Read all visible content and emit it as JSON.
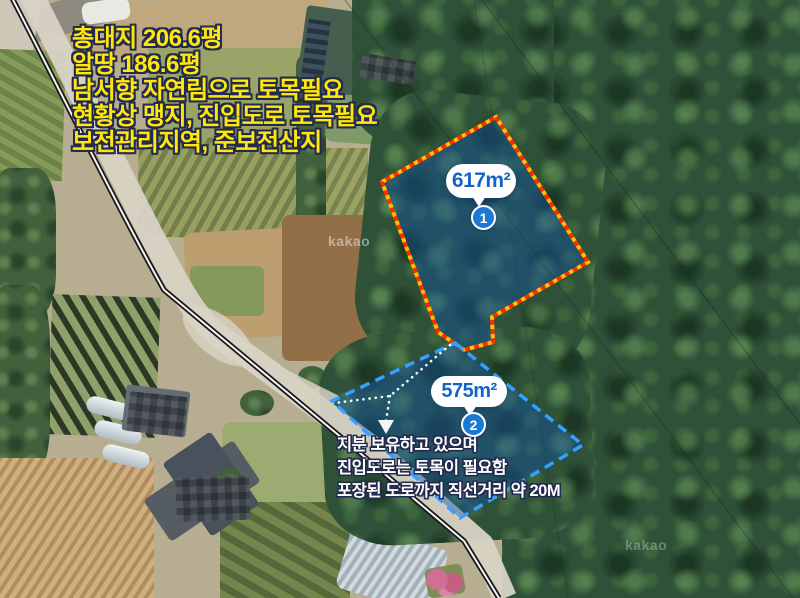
{
  "map": {
    "watermarks": [
      "kakao",
      "kakao"
    ]
  },
  "notes": {
    "top": {
      "color": "#ffe70a",
      "outline_color": "#222a4e",
      "lines": [
        "총대지 206.6평",
        "알땅 186.6평",
        "남서향 자연림으로 토목필요",
        "현황상 맹지, 진입도로 토목필요",
        "보전관리지역, 준보전산지"
      ]
    },
    "bottom": {
      "color": "#ffffff",
      "outline_color": "#222a4e",
      "lines": [
        "지분 보유하고 있으며",
        "진입도로는 토목이 필요함",
        "포장된 도로까지 직선거리 약 20M"
      ]
    }
  },
  "parcels": [
    {
      "badge": "1",
      "area": "617m²",
      "outline": "#ff2b00",
      "outline_accent": "#ffc400",
      "fill": "rgba(17,82,168,0.42)",
      "label_color": "#1464c8"
    },
    {
      "badge": "2",
      "area": "575m²",
      "outline": "#34a0ff",
      "fill": "rgba(17,82,168,0.42)",
      "label_color": "#1464c8"
    }
  ]
}
